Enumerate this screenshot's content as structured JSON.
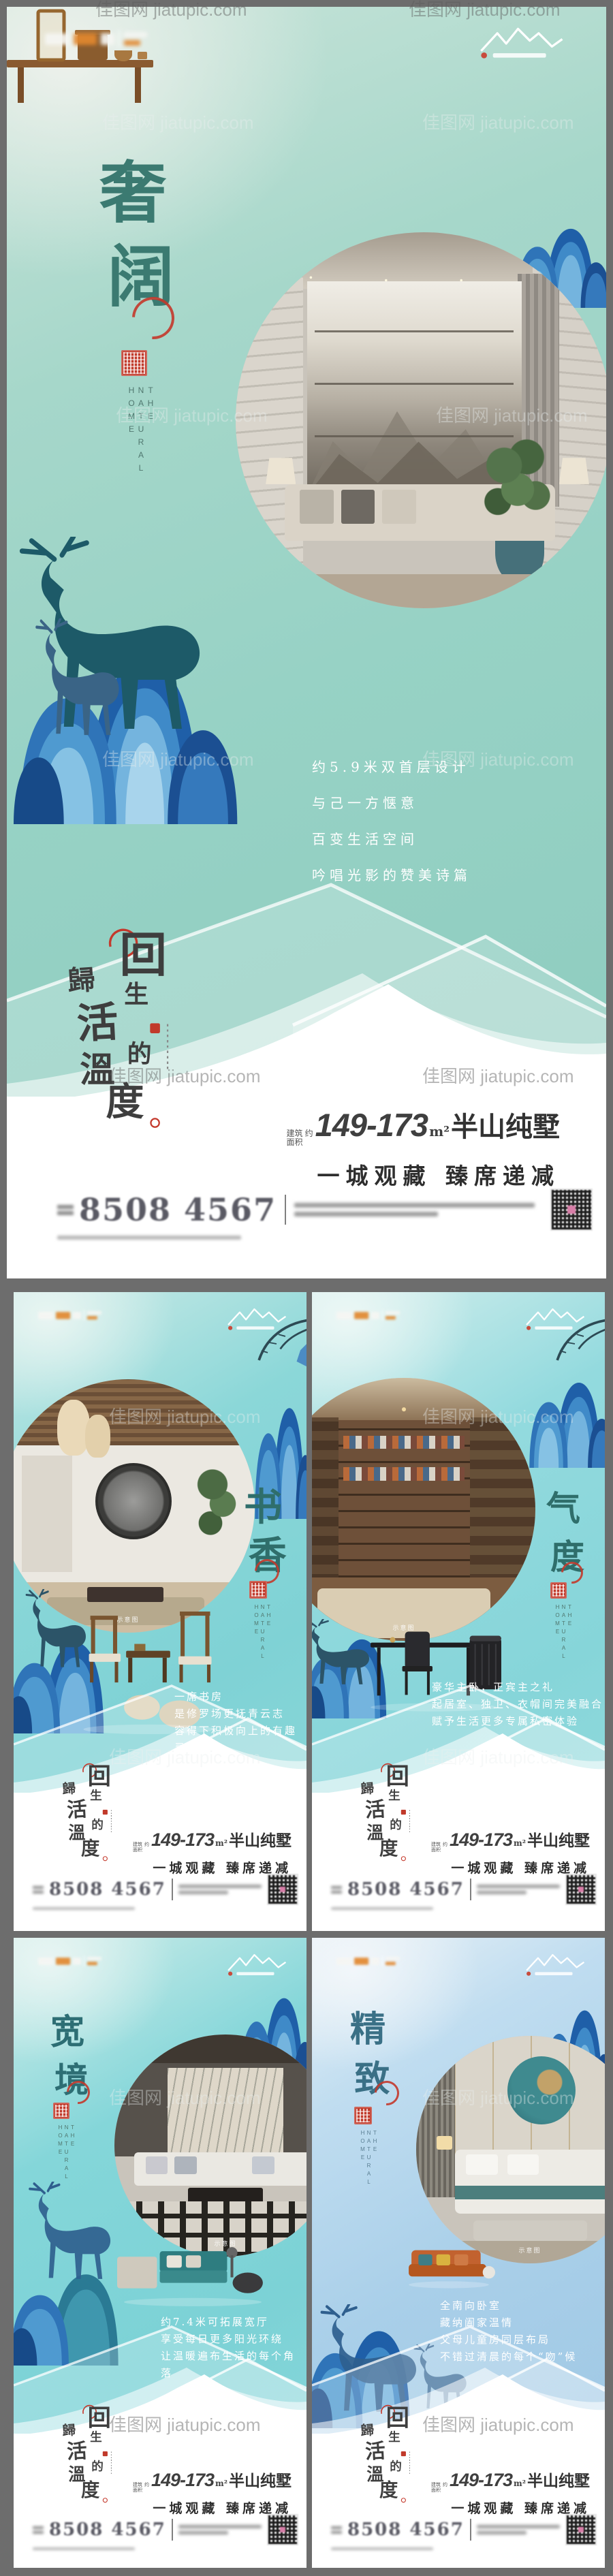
{
  "watermark": "佳图网 jiatupic.com",
  "brand": {
    "area_prefix_1": "建筑",
    "area_prefix_2": "面积",
    "area_approx": "约",
    "area_number": "149-173",
    "area_unit": "m²",
    "area_suffix": "半山纯墅",
    "tagline": "一城观藏  臻席递减",
    "phone": "8508 4567",
    "english_sub": "THE NATURAL HOME",
    "photo_caption": "示意图",
    "slogan": [
      "回",
      "歸",
      "生",
      "活",
      "的",
      "溫",
      "度"
    ],
    "accent_red": "#c13a2b",
    "hill_blue": "#2f74b8",
    "teal_background": "#8ccbbe"
  },
  "posters": [
    {
      "title": [
        "奢",
        "阔"
      ],
      "paragraph": [
        "约5.9米双首层设计",
        "与己一方惬意",
        "百变生活空间",
        "吟唱光影的赞美诗篇"
      ]
    },
    {
      "title": [
        "书",
        "香"
      ],
      "paragraph": [
        "一席书房",
        "是修罗场更抚青云志",
        "容得下积极向上的有趣灵魂",
        ""
      ]
    },
    {
      "title": [
        "气",
        "度"
      ],
      "paragraph": [
        "豪华主卧，正宾主之礼",
        "起居室、独卫、衣帽间完美融合",
        "赋予生活更多专属私密体验",
        ""
      ]
    },
    {
      "title": [
        "宽",
        "境"
      ],
      "paragraph": [
        "约7.4米可拓展宽厅",
        "享受每日更多阳光环绕",
        "让温暖遍布生活的每个角落",
        ""
      ]
    },
    {
      "title": [
        "精",
        "致"
      ],
      "paragraph": [
        "全南向卧室",
        "藏纳阖家温情",
        "父母儿童房同层布局",
        "不错过清晨的每个“吻”候"
      ]
    }
  ]
}
